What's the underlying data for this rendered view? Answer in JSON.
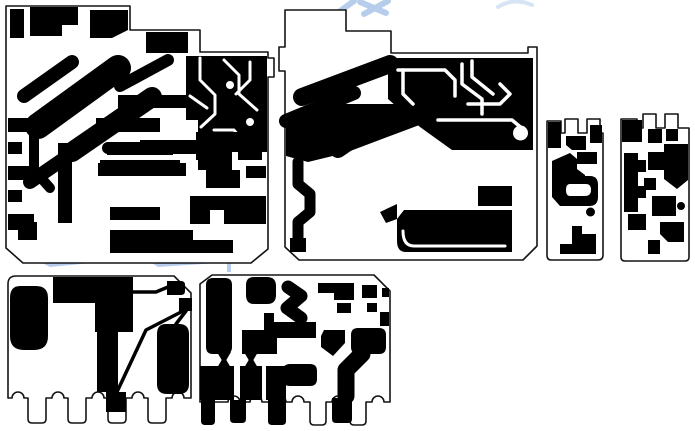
{
  "meta": {
    "description": "Black-and-white PCB copper-layer artwork panel with six board outlines",
    "board_count": 6,
    "background": "#ffffff",
    "copper_color": "#000000",
    "outline_color": "#141414",
    "watermark_color": "#a9c4e8"
  },
  "canvas": {
    "width": 695,
    "height": 431
  },
  "watermark": {
    "color": "#a9c4e8",
    "opacity": 0.85,
    "shapes": [
      {
        "d": "M 336,14 L 354,1",
        "stroke": "#a9c4e8",
        "sw": 6
      },
      {
        "d": "M 360,2 L 386,13",
        "stroke": "#a9c4e8",
        "sw": 6
      },
      {
        "d": "M 388,1 L 364,14",
        "stroke": "#a9c4e8",
        "sw": 6
      },
      {
        "d": "M 498,7 Q 514,-3 532,5",
        "stroke": "#a9c4e8",
        "sw": 4,
        "opacity": 0.55
      },
      {
        "d": "M 42,263 L 110,257 L 113,261 L 50,267 Z",
        "fill": "#a9c4e8"
      },
      {
        "d": "M 120,259 L 179,255 L 181,259 L 124,263 Z",
        "fill": "#a9c4e8"
      },
      {
        "d": "M 152,263 L 231,258 L 233,262 L 158,267 Z",
        "fill": "#a9c4e8"
      },
      {
        "d": "M 227,258 H 231 V 272 H 227 Z",
        "fill": "#a9c4e8"
      }
    ]
  },
  "boards": [
    {
      "name": "board-top-left",
      "outline": {
        "d": "M 6,6 H 130 V 30 H 200 V 52 H 268 V 58 H 274 V 77 H 268 V 249 L 251,263 H 23 L 6,248 Z",
        "fill": "#ffffff",
        "stroke": "#141414",
        "sw": 1.6
      },
      "shapes": [
        {
          "d": "M 10,9 H 24 V 38 H 10 Z",
          "fill": "#000000"
        },
        {
          "d": "M 30,7 H 78 V 25 H 62 V 36 H 30 Z",
          "fill": "#000000"
        },
        {
          "d": "M 90,10 H 128 V 30 L 112,38 H 90 Z",
          "fill": "#000000"
        },
        {
          "d": "M 146,32 H 188 V 53 H 146 Z",
          "fill": "#000000"
        },
        {
          "d": "M 38,126 L 118,68",
          "stroke": "#000000",
          "sw": 26
        },
        {
          "d": "M 24,96 L 72,62",
          "stroke": "#000000",
          "sw": 14
        },
        {
          "d": "M 72,152 L 152,97",
          "stroke": "#000000",
          "sw": 20
        },
        {
          "d": "M 30,182 L 97,136",
          "stroke": "#000000",
          "sw": 14
        },
        {
          "d": "M 120,86 L 168,60",
          "stroke": "#000000",
          "sw": 12
        },
        {
          "d": "M 8,118 H 30 V 132 H 8 Z",
          "fill": "#000000"
        },
        {
          "d": "M 8,142 H 22 V 154 H 8 Z",
          "fill": "#000000"
        },
        {
          "d": "M 8,166 H 30 V 180 H 8 Z",
          "fill": "#000000"
        },
        {
          "d": "M 8,190 H 22 V 202 H 8 Z",
          "fill": "#000000"
        },
        {
          "d": "M 8,214 H 34 V 230 H 8 Z",
          "fill": "#000000"
        },
        {
          "d": "M 96,118 H 160 V 132 H 96 Z",
          "fill": "#000000"
        },
        {
          "d": "M 118,95 H 186 V 108 H 118 Z",
          "fill": "#000000"
        },
        {
          "d": "M 140,140 H 216 V 154 H 140 Z",
          "fill": "#000000"
        },
        {
          "d": "M 98,163 H 186 V 176 H 98 Z",
          "fill": "#000000"
        },
        {
          "d": "M 102,148 a 6,6 0 1 0 12,0 a 6,6 0 1 0 -12,0 Z",
          "fill": "#000000"
        },
        {
          "d": "M 186,56 H 267 V 152 H 232 V 170 H 198 V 120 H 186 Z",
          "fill": "#000000"
        },
        {
          "d": "M 200,58 L 200,80 L 215,95 L 215,114 L 201,127",
          "stroke": "#ffffff",
          "sw": 3
        },
        {
          "d": "M 224,60 L 239,75 L 239,94 L 257,110",
          "stroke": "#ffffff",
          "sw": 3
        },
        {
          "d": "M 250,62 V 80 L 236,94",
          "stroke": "#ffffff",
          "sw": 3
        },
        {
          "d": "M 214,130 H 234 L 245,144",
          "stroke": "#ffffff",
          "sw": 3
        },
        {
          "d": "M 190,96 L 207,108",
          "stroke": "#ffffff",
          "sw": 3
        },
        {
          "d": "M 226,85 a 4,4 0 1 0 8,0 a 4,4 0 1 0 -8,0 Z",
          "fill": "#ffffff"
        },
        {
          "d": "M 246,122 a 4,4 0 1 0 8,0 a 4,4 0 1 0 -8,0 Z",
          "fill": "#ffffff"
        },
        {
          "d": "M 58,143 H 72 V 223 H 58 Z",
          "fill": "#000000"
        },
        {
          "d": "M 34,130 L 34,170 L 50,188",
          "stroke": "#000000",
          "sw": 10
        },
        {
          "d": "M 18,222 H 37 V 240 H 18 Z",
          "fill": "#000000"
        },
        {
          "d": "M 107,142 H 173 V 155 H 107 Z",
          "fill": "#000000"
        },
        {
          "d": "M 100,160 H 180 V 171 H 100 Z",
          "fill": "#000000"
        },
        {
          "d": "M 110,207 H 160 V 220 H 110 Z",
          "fill": "#000000"
        },
        {
          "d": "M 110,230 H 193 V 240 H 233 V 253 H 110 Z",
          "fill": "#000000"
        },
        {
          "d": "M 196,132 H 262 V 160 H 238 V 148 H 212 V 160 H 196 Z",
          "fill": "#000000"
        },
        {
          "d": "M 206,170 H 240 V 188 H 206 Z",
          "fill": "#000000"
        },
        {
          "d": "M 246,166 H 266 V 178 H 246 Z",
          "fill": "#000000"
        },
        {
          "d": "M 190,196 H 266 V 224 H 224 V 210 H 210 V 224 H 190 Z",
          "fill": "#000000"
        }
      ]
    },
    {
      "name": "board-top-middle",
      "outline": {
        "d": "M 285,10 H 346 V 31 H 391 V 53 H 528 V 47 H 537 V 246 L 523,260 H 299 L 285,247 V 71 H 279 V 47 H 285 Z",
        "fill": "#ffffff",
        "stroke": "#141414",
        "sw": 1.6
      },
      "shapes": [
        {
          "d": "M 388,58 H 533 V 150 H 452 L 420,127 L 388,99 Z",
          "fill": "#000000"
        },
        {
          "d": "M 302,97 L 390,64",
          "stroke": "#000000",
          "sw": 18
        },
        {
          "d": "M 286,121 L 354,93",
          "stroke": "#000000",
          "sw": 14
        },
        {
          "d": "M 286,128 L 330,104 L 422,104 L 422,124 L 345,153 L 308,162 L 286,156 Z",
          "fill": "#000000"
        },
        {
          "d": "M 338,150 L 370,128",
          "stroke": "#000000",
          "sw": 16
        },
        {
          "d": "M 298,162 L 298,184 L 310,194 L 310,212 L 298,222 L 298,244",
          "stroke": "#000000",
          "sw": 11
        },
        {
          "d": "M 290,238 H 306 V 252 H 290 Z",
          "fill": "#000000"
        },
        {
          "d": "M 398,70 H 445 L 455,80 V 96",
          "stroke": "#ffffff",
          "sw": 3.5
        },
        {
          "d": "M 403,70 V 94 L 413,104",
          "stroke": "#ffffff",
          "sw": 3.5
        },
        {
          "d": "M 462,64 V 84 L 482,99 V 114",
          "stroke": "#ffffff",
          "sw": 3.5
        },
        {
          "d": "M 472,61 V 77 L 493,94",
          "stroke": "#ffffff",
          "sw": 3.5
        },
        {
          "d": "M 468,104 H 500 L 510,94 L 500,84",
          "stroke": "#ffffff",
          "sw": 3.5
        },
        {
          "d": "M 438,120 H 512 L 524,130",
          "stroke": "#ffffff",
          "sw": 3.5
        },
        {
          "d": "M 513,133 a 7.5,7.5 0 1 0 15,0 a 7.5,7.5 0 1 0 -15,0 Z",
          "fill": "#ffffff"
        },
        {
          "d": "M 404,210 H 512 V 252 H 406 Q 397,252 397,241 V 219 Z",
          "fill": "#000000"
        },
        {
          "d": "M 403,231 Q 403,246 414,246 H 505",
          "stroke": "#ffffff",
          "sw": 3
        },
        {
          "d": "M 478,186 H 512 V 206 H 478 Z",
          "fill": "#000000"
        },
        {
          "d": "M 380,212 L 397,204 V 219 L 386,223 Z",
          "fill": "#000000"
        }
      ]
    },
    {
      "name": "board-small-left",
      "outline": {
        "d": "M 547,121 H 561 V 133 H 565 V 119 H 578 V 133 H 587 V 119 H 600 V 133 H 603 V 255 Q 603,260 598,260 H 551 Q 547,260 547,255 Z",
        "fill": "#ffffff",
        "stroke": "#141414",
        "sw": 1.6
      },
      "shapes": [
        {
          "d": "M 548,122 H 561 V 148 H 548 Z",
          "fill": "#000000"
        },
        {
          "d": "M 590,125 H 602 V 143 H 590 Z",
          "fill": "#000000"
        },
        {
          "d": "M 566,136 H 586 V 150 H 572 L 566,145 Z",
          "fill": "#000000"
        },
        {
          "d": "M 552,161 L 570,153 L 577,159 V 169 L 585,175 V 196 L 574,206 H 560 L 552,197 Z",
          "fill": "#000000"
        },
        {
          "d": "M 577,152 H 597 V 164 H 577 Z",
          "fill": "#000000"
        },
        {
          "d": "M 562,176 H 590 Q 598,176 598,185 V 197 Q 598,206 589,206 H 562 Z",
          "fill": "#000000"
        },
        {
          "d": "M 570,184 H 586 Q 591,184 591,190 Q 591,196 585,196 H 570 Q 566,196 566,190 Q 566,184 570,184 Z",
          "fill": "#ffffff"
        },
        {
          "d": "M 586,212 a 4.5,4.5 0 1 0 9,0 a 4.5,4.5 0 1 0 -9,0 Z",
          "fill": "#000000"
        },
        {
          "d": "M 572,226 H 582 V 234 H 596 V 254 H 560 V 244 H 572 Z",
          "fill": "#000000"
        }
      ]
    },
    {
      "name": "board-small-right",
      "outline": {
        "d": "M 621,119 H 637 V 128 H 643 V 114 H 656 V 128 H 665 V 114 H 678 V 128 H 689 V 257 Q 689,261 685,261 H 625 Q 621,261 621,257 Z",
        "fill": "#ffffff",
        "stroke": "#141414",
        "sw": 1.6
      },
      "shapes": [
        {
          "d": "M 622,120 H 642 V 142 H 622 Z",
          "fill": "#000000"
        },
        {
          "d": "M 648,129 H 662 V 143 H 648 Z",
          "fill": "#000000"
        },
        {
          "d": "M 666,129 H 678 V 141 H 666 Z",
          "fill": "#000000"
        },
        {
          "d": "M 664,144 H 688 V 180 L 677,189 L 664,179 Z",
          "fill": "#000000"
        },
        {
          "d": "M 624,153 H 638 V 212 H 624 Z",
          "fill": "#000000"
        },
        {
          "d": "M 638,160 H 646 V 172 H 638 Z",
          "fill": "#000000"
        },
        {
          "d": "M 638,186 H 646 V 198 H 638 Z",
          "fill": "#000000"
        },
        {
          "d": "M 648,152 H 664 V 170 H 648 Z",
          "fill": "#000000"
        },
        {
          "d": "M 644,178 H 656 V 190 H 644 Z",
          "fill": "#000000"
        },
        {
          "d": "M 652,196 H 676 V 216 H 652 Z",
          "fill": "#000000"
        },
        {
          "d": "M 628,214 H 646 V 230 H 628 Z",
          "fill": "#000000"
        },
        {
          "d": "M 660,222 H 684 V 242 H 668 L 660,234 Z",
          "fill": "#000000"
        },
        {
          "d": "M 648,240 H 660 V 254 H 648 Z",
          "fill": "#000000"
        },
        {
          "d": "M 677,206 a 4,4 0 1 0 8,0 a 4,4 0 1 0 -8,0 Z",
          "fill": "#000000"
        }
      ]
    },
    {
      "name": "board-bottom-left",
      "outline": {
        "d": "M 16,276 Q 8,276 8,284 V 398 H 12 a 6,6 0 0 1 12,0 H 28 V 419 Q 28,423 32,423 H 42 Q 46,423 46,419 V 398 H 52 a 6,6 0 0 1 12,0 H 68 V 419 Q 68,423 72,423 H 82 Q 86,423 86,419 V 398 H 92 a 6,6 0 0 1 12,0 H 108 V 419 Q 108,423 112,423 H 122 Q 126,423 126,419 V 398 H 132 a 6,6 0 0 1 12,0 H 148 V 419 Q 148,423 152,423 H 162 Q 166,423 166,419 V 398 H 172 a 6,6 0 0 1 12,0 H 191 V 293 L 174,276 Z",
        "fill": "#ffffff",
        "stroke": "#141414",
        "sw": 1.6
      },
      "shapes": [
        {
          "d": "M 20,286 Q 10,286 10,298 V 336 Q 10,350 24,350 H 34 Q 48,350 48,336 V 298 Q 48,286 36,286 Z",
          "fill": "#000000"
        },
        {
          "d": "M 53,277 H 133 V 303 H 53 Z",
          "fill": "#000000"
        },
        {
          "d": "M 95,296 H 133 V 332 H 95 Z",
          "fill": "#000000"
        },
        {
          "d": "M 97,325 H 118 V 392 H 97 Z",
          "fill": "#000000"
        },
        {
          "d": "M 133,292 H 156 L 168,287",
          "stroke": "#000000",
          "sw": 3.5
        },
        {
          "d": "M 167,281 H 181 Q 185,281 185,285 V 291 Q 185,295 181,295 H 167 Z",
          "fill": "#000000"
        },
        {
          "d": "M 179,298 H 192 V 311 H 179 Z",
          "fill": "#000000"
        },
        {
          "d": "M 183,311 L 146,330 L 116,394",
          "stroke": "#000000",
          "sw": 3.5
        },
        {
          "d": "M 106,392 H 126 V 412 H 106 Z",
          "fill": "#000000"
        },
        {
          "d": "M 166,324 Q 157,324 157,334 V 384 Q 157,394 167,394 H 179 Q 189,394 189,384 V 334 Q 189,324 179,324 Z",
          "fill": "#000000"
        },
        {
          "d": "M 186,311 L 176,324",
          "stroke": "#000000",
          "sw": 3.5
        }
      ]
    },
    {
      "name": "board-bottom-middle",
      "outline": {
        "d": "M 200,284 L 212,275 H 374 L 390,291 V 402 H 384 a 6,6 0 0 0 -12,0 H 366 L 366,421 Q 366,425 362,425 H 354 Q 350,425 350,421 V 402 H 344 a 6,6 0 0 0 -12,0 H 326 V 421 Q 326,425 322,425 H 314 Q 310,425 310,421 V 402 H 304 a 6,6 0 0 0 -12,0 H 286 a 6,6 0 0 0 -12,0 H 262 a 6,6 0 0 0 -12,0 H 240 a 6,6 0 0 0 -12,0 H 200 V 284 Z",
        "fill": "#ffffff",
        "stroke": "#141414",
        "sw": 1.6
      },
      "shapes": [
        {
          "d": "M 213,278 H 225 Q 232,278 232,285 V 347 Q 232,354 225,354 H 213 Q 206,354 206,347 V 285 Q 206,278 213,278 Z",
          "fill": "#000000"
        },
        {
          "d": "M 254,277 H 267 Q 276,277 276,286 V 295 Q 276,304 267,304 H 254 Q 246,304 246,295 V 285 Q 246,277 254,277 Z",
          "fill": "#000000"
        },
        {
          "d": "M 288,287 L 301,296 L 287,308 L 301,318",
          "stroke": "#000000",
          "sw": 13
        },
        {
          "d": "M 264,313 H 274 V 334 H 264 Z",
          "fill": "#000000"
        },
        {
          "d": "M 242,330 H 277 V 354 H 242 Z",
          "fill": "#000000"
        },
        {
          "d": "M 272,322 H 316 V 338 H 272 Z",
          "fill": "#000000"
        },
        {
          "d": "M 324,330 H 345 V 343 L 333,356 L 321,347 V 336 Z",
          "fill": "#000000"
        },
        {
          "d": "M 358,328 H 379 Q 386,328 386,335 V 347 Q 386,354 379,354 H 358 Q 351,354 351,347 V 335 Q 351,328 358,328 Z",
          "fill": "#000000"
        },
        {
          "d": "M 318,283 H 354 V 300 H 334 V 293 H 318 Z",
          "fill": "#000000"
        },
        {
          "d": "M 337,303 H 351 V 313 H 337 Z",
          "fill": "#000000"
        },
        {
          "d": "M 362,285 H 377 V 298 H 362 Z",
          "fill": "#000000"
        },
        {
          "d": "M 367,303 H 377 V 312 H 367 Z",
          "fill": "#000000"
        },
        {
          "d": "M 382,288 H 389 V 297 H 382 Z",
          "fill": "#000000"
        },
        {
          "d": "M 380,312 H 389 V 326 H 380 Z",
          "fill": "#000000"
        },
        {
          "d": "M 217,352 L 231,352 L 224,364 Z",
          "fill": "#000000"
        },
        {
          "d": "M 217,368 L 231,368 L 224,356 Z",
          "fill": "#000000"
        },
        {
          "d": "M 244,352 L 258,352 L 251,364 Z",
          "fill": "#000000"
        },
        {
          "d": "M 244,368 L 258,368 L 251,356 Z",
          "fill": "#000000"
        },
        {
          "d": "M 200,366 H 234 V 400 H 200 Z",
          "fill": "#000000"
        },
        {
          "d": "M 240,366 H 262 V 400 H 240 Z",
          "fill": "#000000"
        },
        {
          "d": "M 266,366 H 286 V 400 H 266 Z",
          "fill": "#000000"
        },
        {
          "d": "M 201,400 H 215 V 421 Q 215,425 211,425 H 205 Q 201,425 201,421 Z",
          "fill": "#000000"
        },
        {
          "d": "M 230,400 H 246 V 419 Q 246,423 242,423 H 234 Q 230,423 230,419 Z",
          "fill": "#000000"
        },
        {
          "d": "M 268,400 H 286 V 421 Q 286,425 282,425 H 272 Q 268,425 268,421 Z",
          "fill": "#000000"
        },
        {
          "d": "M 290,364 H 310 Q 317,364 317,371 V 379 Q 317,386 310,386 H 290 Q 283,386 283,379 V 371 Q 283,364 290,364 Z",
          "fill": "#000000"
        },
        {
          "d": "M 362,354 L 346,370 L 346,396",
          "stroke": "#000000",
          "sw": 17
        },
        {
          "d": "M 332,398 H 352 V 419 Q 352,423 348,423 H 336 Q 332,423 332,419 Z",
          "fill": "#000000"
        }
      ]
    }
  ]
}
